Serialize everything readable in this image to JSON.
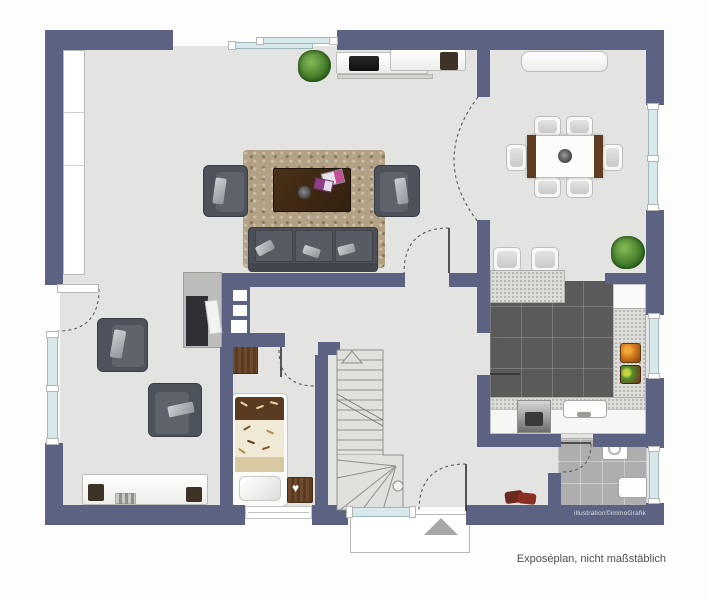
{
  "texts": {
    "watermark": "illustration©immoGrafik",
    "caption": "Exposéplan, nicht maßstäblich"
  },
  "colors": {
    "wall": "#5b6282",
    "floor": "#e3e3e1",
    "kitchen_tile": "#5a5a5a",
    "bath_tile": "#aeaeae",
    "counter": "#dcdcd8",
    "glass": "#d8e9ec",
    "rug": "#b2a184",
    "sofa": "#4b5058",
    "wood": "#6e4a2c",
    "plant_green": "#4c8a33",
    "porch_triangle": "#a7a7a7"
  },
  "plan": {
    "type": "floor-plan",
    "rooms": [
      {
        "name": "living-room",
        "furniture": [
          "tv-sideboard",
          "tv",
          "plant",
          "rug",
          "coffee-table",
          "magazines",
          "sofa-3seat",
          "armchair-left",
          "armchair-right"
        ]
      },
      {
        "name": "dining-room",
        "furniture": [
          "sideboard",
          "dining-table",
          "six-chairs",
          "bowl",
          "plant"
        ]
      },
      {
        "name": "kitchen",
        "furniture": [
          "breakfast-counter",
          "two-bar-stools",
          "fridge-counter",
          "side-counter",
          "fruit-bowls",
          "sink",
          "oven",
          "base-cabinets"
        ]
      },
      {
        "name": "bathroom",
        "furniture": [
          "washbasin",
          "toilet"
        ]
      },
      {
        "name": "bedroom",
        "furniture": [
          "single-bed",
          "nightstand-with-heart"
        ]
      },
      {
        "name": "study",
        "furniture": [
          "shelf-cabinet",
          "armchair",
          "armchair",
          "lowboard-with-decor"
        ]
      },
      {
        "name": "hallway",
        "furniture": [
          "staircase-up-arrow",
          "wood-cabinet",
          "shoes",
          "entrance-door",
          "porch-step"
        ]
      }
    ],
    "openings": [
      "left-terrace-door",
      "left-window",
      "top-window-band",
      "dining-right-window",
      "kitchen-right-window",
      "bath-right-window",
      "bedroom-bottom-window",
      "entrance-sidelight",
      "entrance-door"
    ]
  }
}
